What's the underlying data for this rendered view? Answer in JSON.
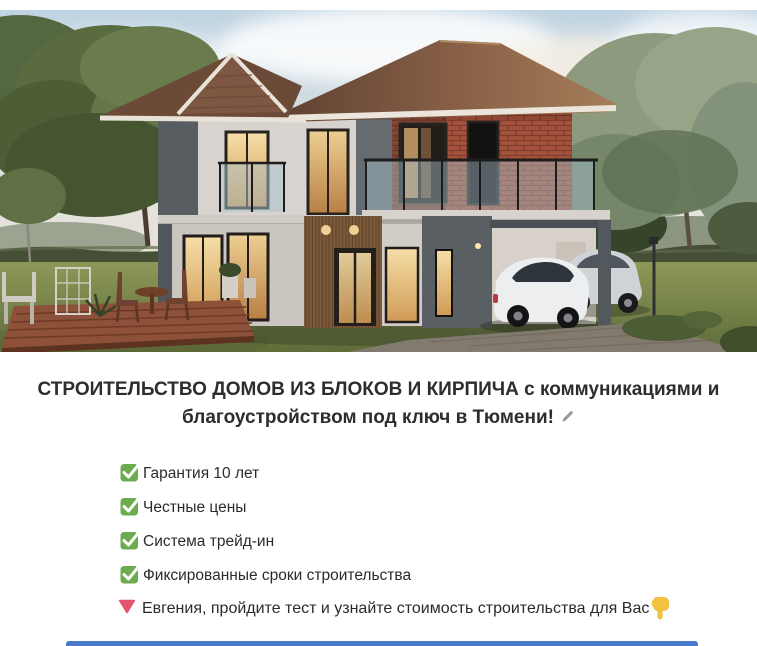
{
  "hero": {
    "alt": "3D render of a two-story house of blocks and brick with carport, two cars, wooden deck and garden"
  },
  "heading": {
    "text": "СТРОИТЕЛЬСТВО ДОМОВ ИЗ БЛОКОВ И КИРПИЧА с коммуникациями и благоустройством под ключ в Тюмени!",
    "edit_icon": "pencil-icon"
  },
  "checklist": {
    "items": [
      "Гарантия 10 лет",
      "Честные цены",
      "Система трейд-ин",
      "Фиксированные сроки строительства"
    ]
  },
  "cta": {
    "lead_icon": "red-triangle-down-icon",
    "text": "Евгения, пройдите тест и узнайте стоимость строительства для Вас",
    "trail_icon": "pointing-down-icon"
  },
  "colors": {
    "check_green": "#6CAB50",
    "triangle_red": "#E4566B",
    "hand_yellow": "#F2C142",
    "pencil_gray": "#9A9A9A",
    "quiz_edge_blue": "#4B79CC",
    "heading_text": "#2D2D2D",
    "body_text": "#2B2B2B"
  }
}
